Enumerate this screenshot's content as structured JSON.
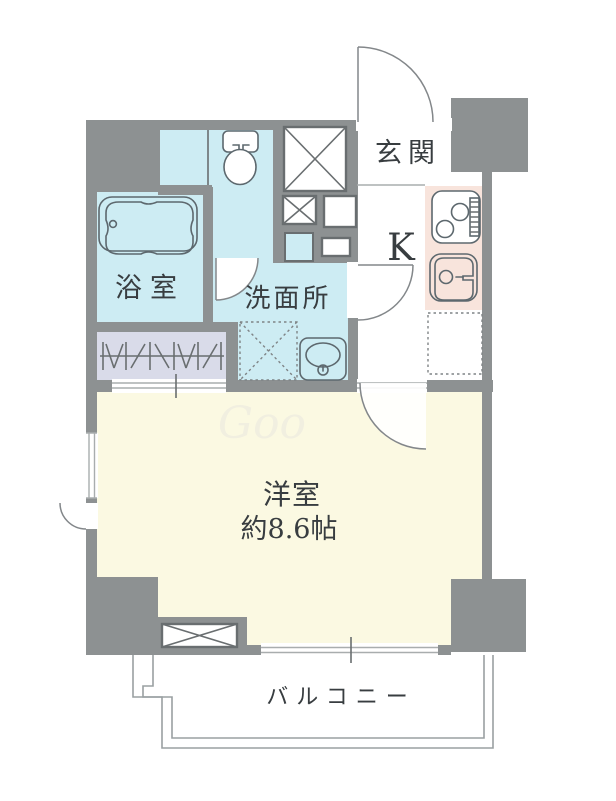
{
  "floorplan": {
    "title": "apartment-floorplan",
    "rooms": {
      "entrance": {
        "label": "玄関"
      },
      "kitchen": {
        "label": "K"
      },
      "bathroom": {
        "label": "浴室"
      },
      "washroom": {
        "label": "洗面所"
      },
      "western_room": {
        "label": "洋室",
        "size_label": "約8.6帖"
      },
      "balcony": {
        "label": "バルコニー"
      }
    },
    "watermark": "Goo",
    "colors": {
      "wall": "#8d9192",
      "cyan": "#cdecf3",
      "lavender": "#d9dbe9",
      "cream": "#fbf9e2",
      "pink": "#f8e4dc",
      "pink_light": "#fbebe4",
      "line": "#5d686e",
      "text": "#383d40"
    }
  }
}
